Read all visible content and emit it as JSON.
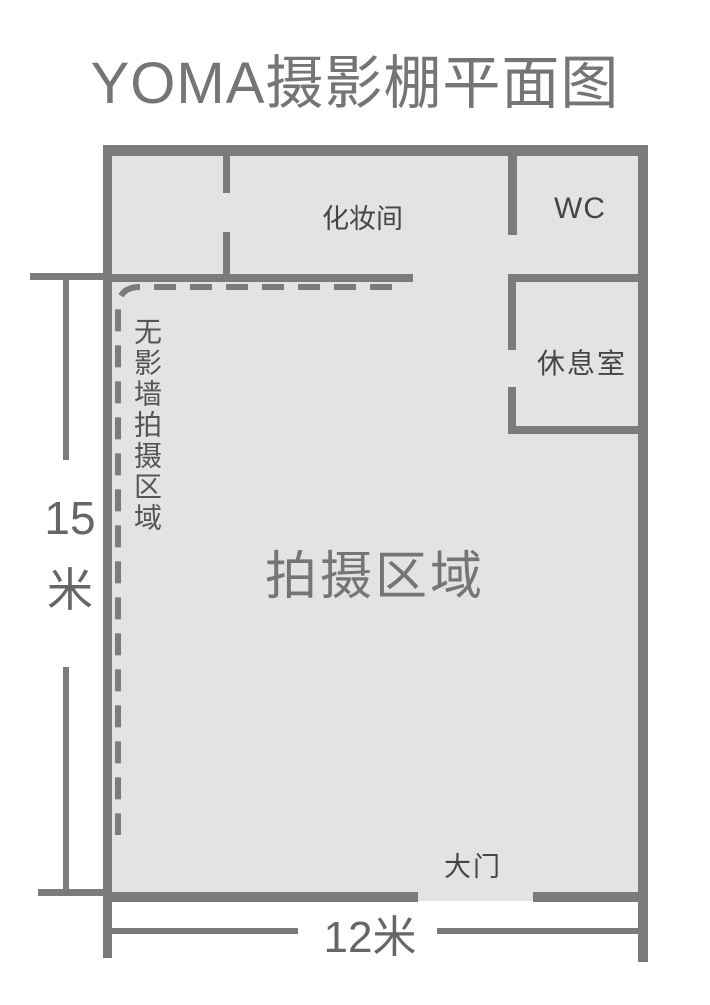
{
  "title": "YOMA摄影棚平面图",
  "colors": {
    "background": "#ffffff",
    "floor": "#e3e3e3",
    "wall": "#7b7b7b",
    "title_text": "#757575",
    "room_label_text": "#454545",
    "area_label_text": "#757575",
    "dimension_text": "#666666"
  },
  "rooms": {
    "makeup_room": {
      "label": "化妆间"
    },
    "toilet": {
      "label": "WC"
    },
    "lounge": {
      "label": "休息室"
    },
    "shooting_area": {
      "label": "拍摄区域"
    },
    "seamless_wall_area": {
      "label": "无影墙拍摄区域"
    },
    "main_gate": {
      "label": "大门"
    }
  },
  "dimensions": {
    "height": {
      "value": "15",
      "unit": "米"
    },
    "width": {
      "label": "12米"
    }
  }
}
